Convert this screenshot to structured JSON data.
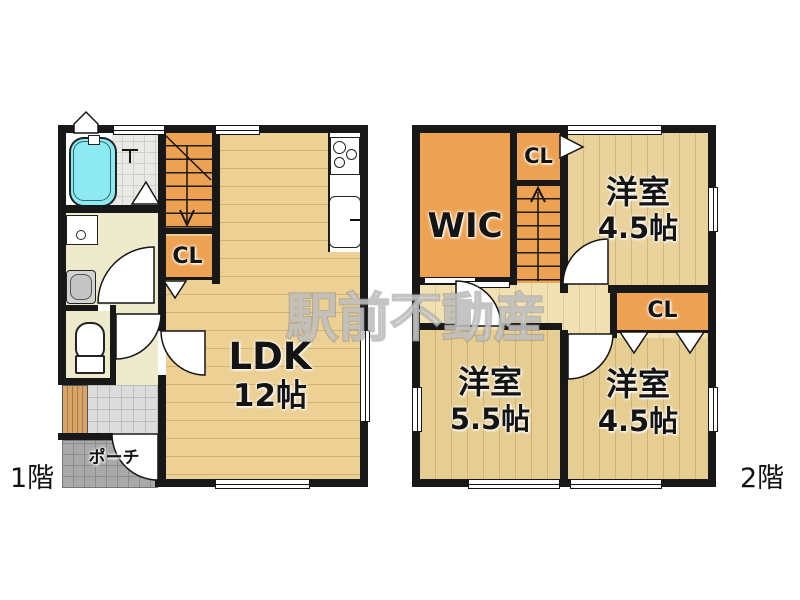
{
  "watermark": "駅前不動産",
  "floor1": {
    "label": "1階",
    "ldk": {
      "name": "LDK",
      "size": "12帖"
    },
    "closet": "CL",
    "porch": "ポーチ"
  },
  "floor2": {
    "label": "2階",
    "wic": "WIC",
    "closet_top": "CL",
    "closet_side": "CL",
    "room_ne": {
      "name": "洋室",
      "size": "4.5帖"
    },
    "room_sw": {
      "name": "洋室",
      "size": "5.5帖"
    },
    "room_se": {
      "name": "洋室",
      "size": "4.5帖"
    }
  },
  "colors": {
    "accent_orange": "#eda253",
    "wood_floor": "#ecd094",
    "bathtub_cyan": "#8deaf2",
    "wall_black": "#181818"
  }
}
